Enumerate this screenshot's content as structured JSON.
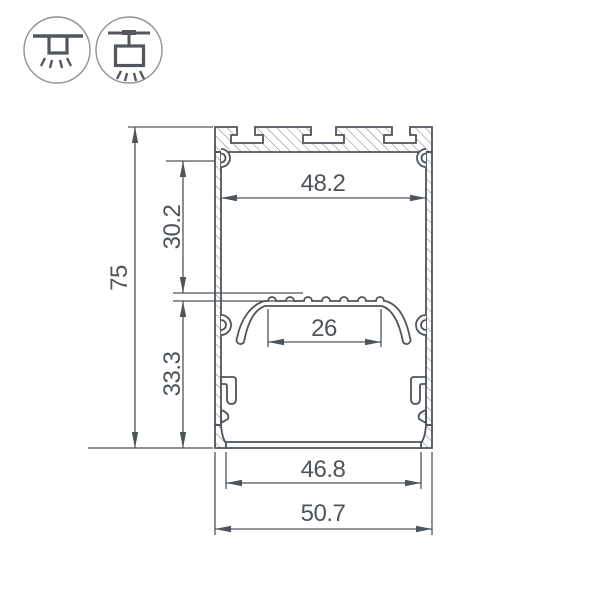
{
  "icons": {
    "surface_mount": {
      "name": "surface-mount-light-icon"
    },
    "pendant_mount": {
      "name": "pendant-mount-light-icon"
    }
  },
  "drawing": {
    "type": "led-profile-cross-section",
    "dimensions": {
      "overall_height": "75",
      "overall_width": "50.7",
      "inner_top_width": "48.2",
      "top_cavity_height": "30.2",
      "led_shelf_width": "26",
      "bottom_cavity_height": "33.3",
      "bottom_opening_width": "46.8"
    },
    "colors": {
      "line": "#4e545b",
      "hatch": "#7a8086",
      "icon_circle": "#8d9399",
      "background": "#ffffff"
    }
  }
}
